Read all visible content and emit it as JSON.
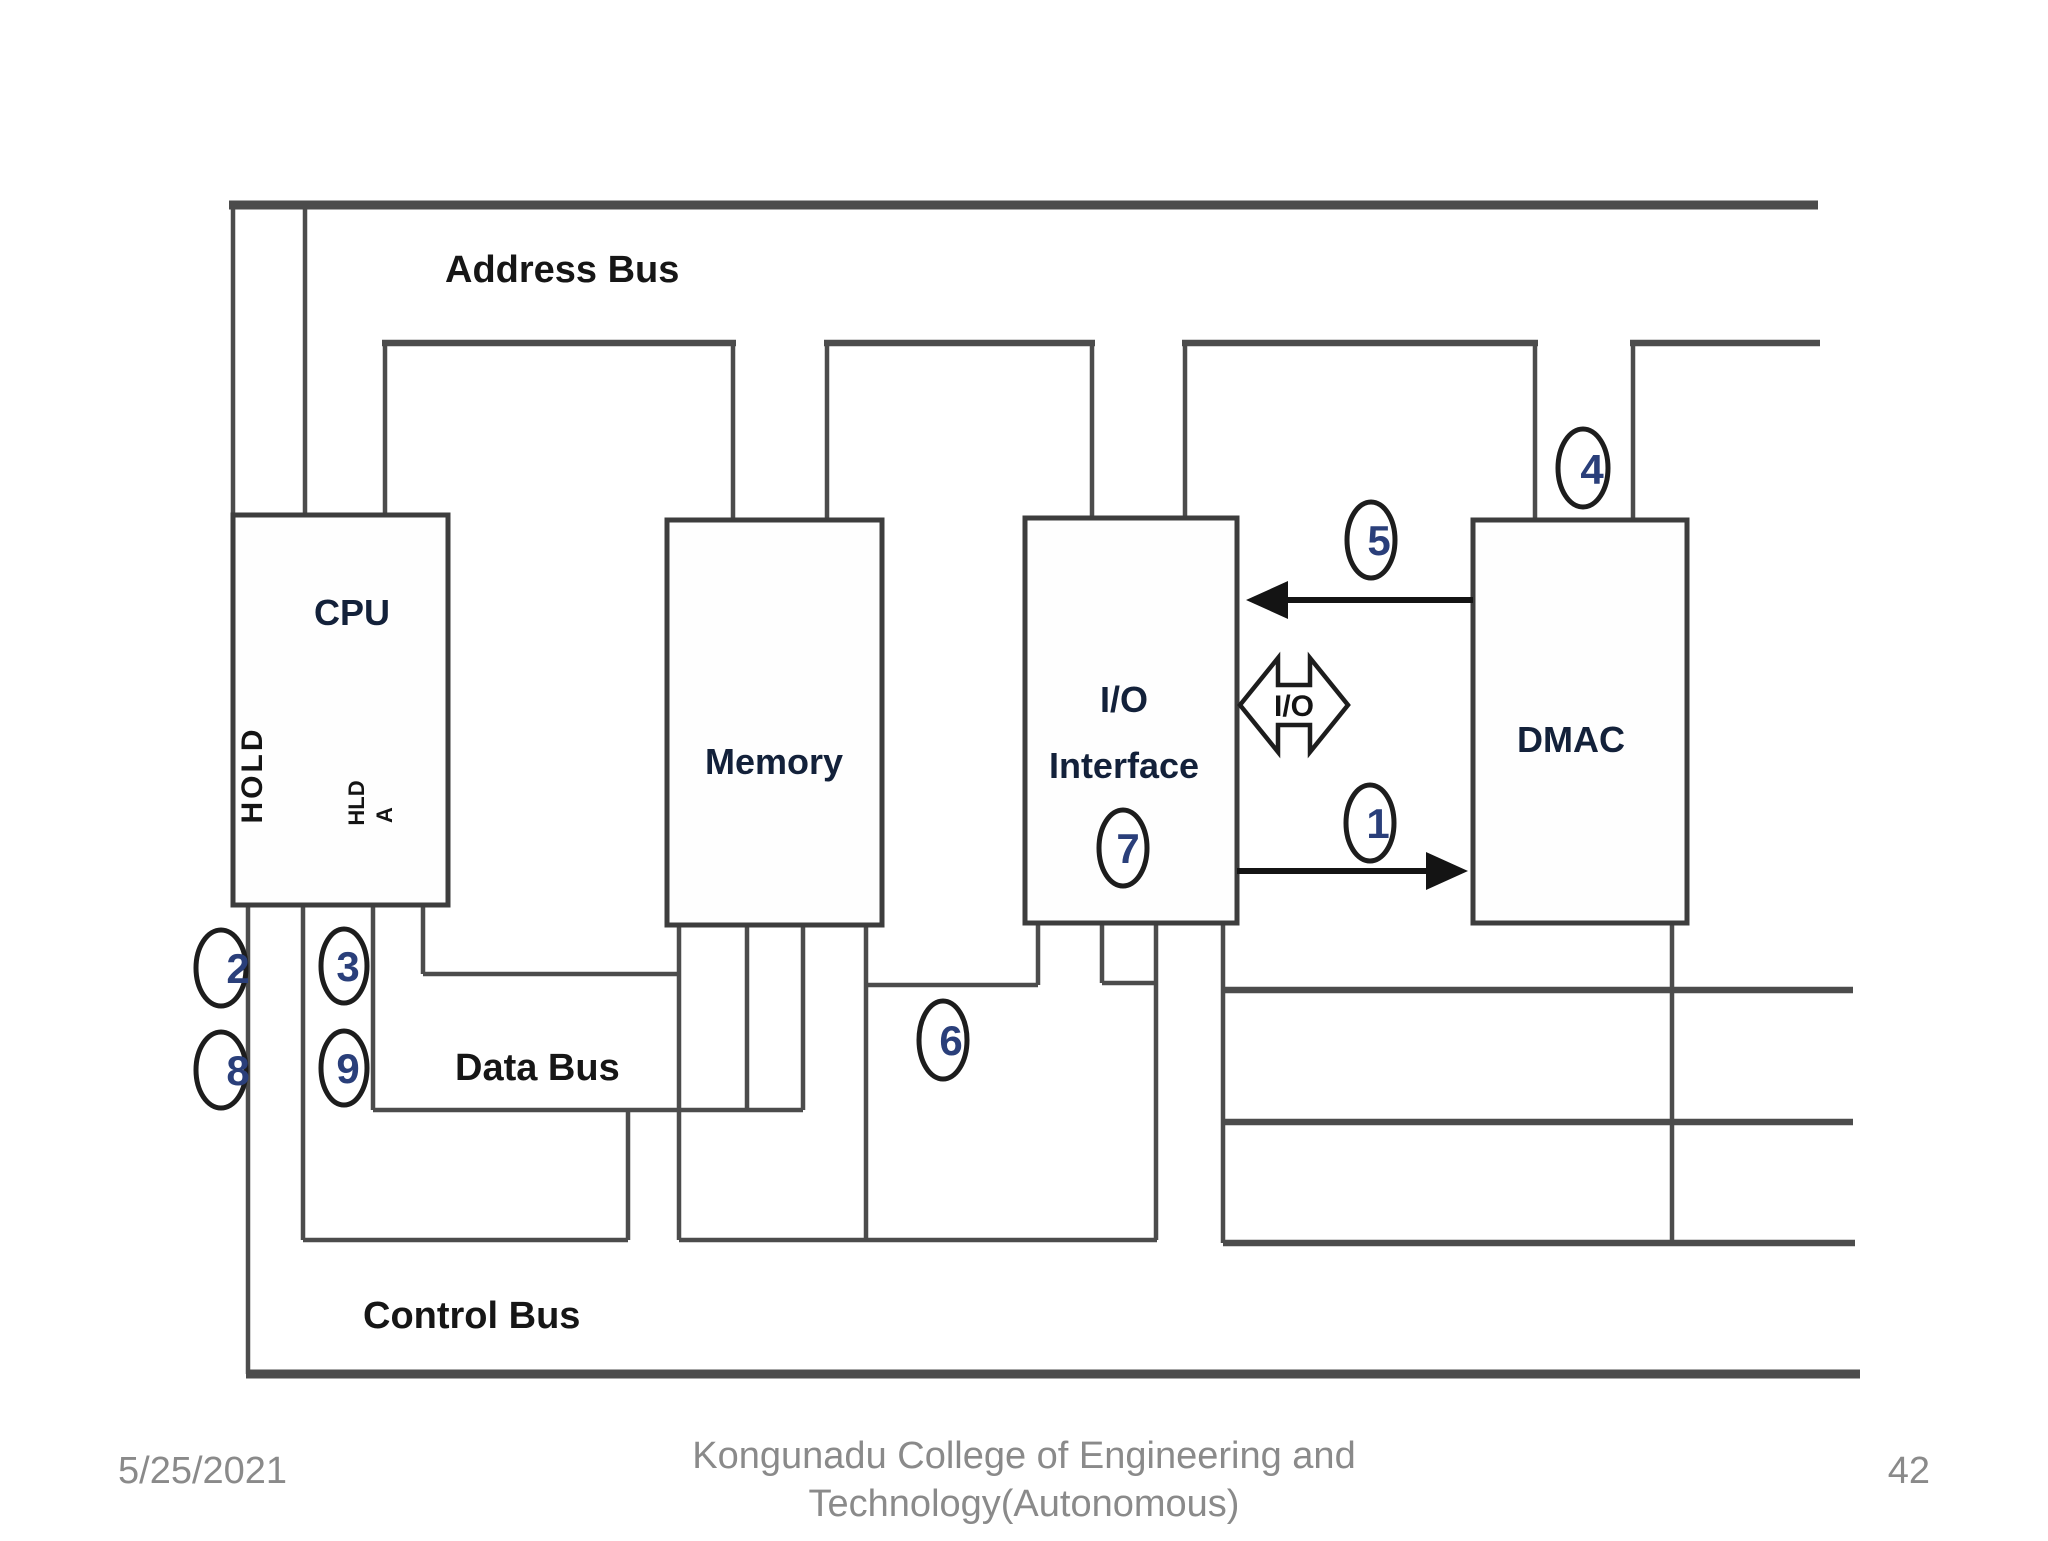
{
  "diagram": {
    "bus_labels": {
      "address": "Address Bus",
      "data": "Data Bus",
      "control": "Control Bus"
    },
    "blocks": {
      "cpu": "CPU",
      "memory": "Memory",
      "io_line1": "I/O",
      "io_line2": "Interface",
      "dmac": "DMAC"
    },
    "cpu_signals": {
      "hold": "HOLD",
      "hlda_part1": "HLD",
      "hlda_part2": "A"
    },
    "io_transfer_arrow_label": "I/O",
    "step_circles": [
      {
        "n": "1"
      },
      {
        "n": "2"
      },
      {
        "n": "3"
      },
      {
        "n": "4"
      },
      {
        "n": "5"
      },
      {
        "n": "6"
      },
      {
        "n": "7"
      },
      {
        "n": "8"
      },
      {
        "n": "9"
      }
    ],
    "colors": {
      "bus_line": "#4c4c4c",
      "block_border": "#3d3d3d",
      "arrow": "#141414",
      "step_number": "#2a3f7a",
      "label_text": "#161616"
    }
  },
  "footer": {
    "date": "5/25/2021",
    "institution_line1": "Kongunadu College of Engineering and",
    "institution_line2": "Technology(Autonomous)",
    "page_number": "42"
  }
}
